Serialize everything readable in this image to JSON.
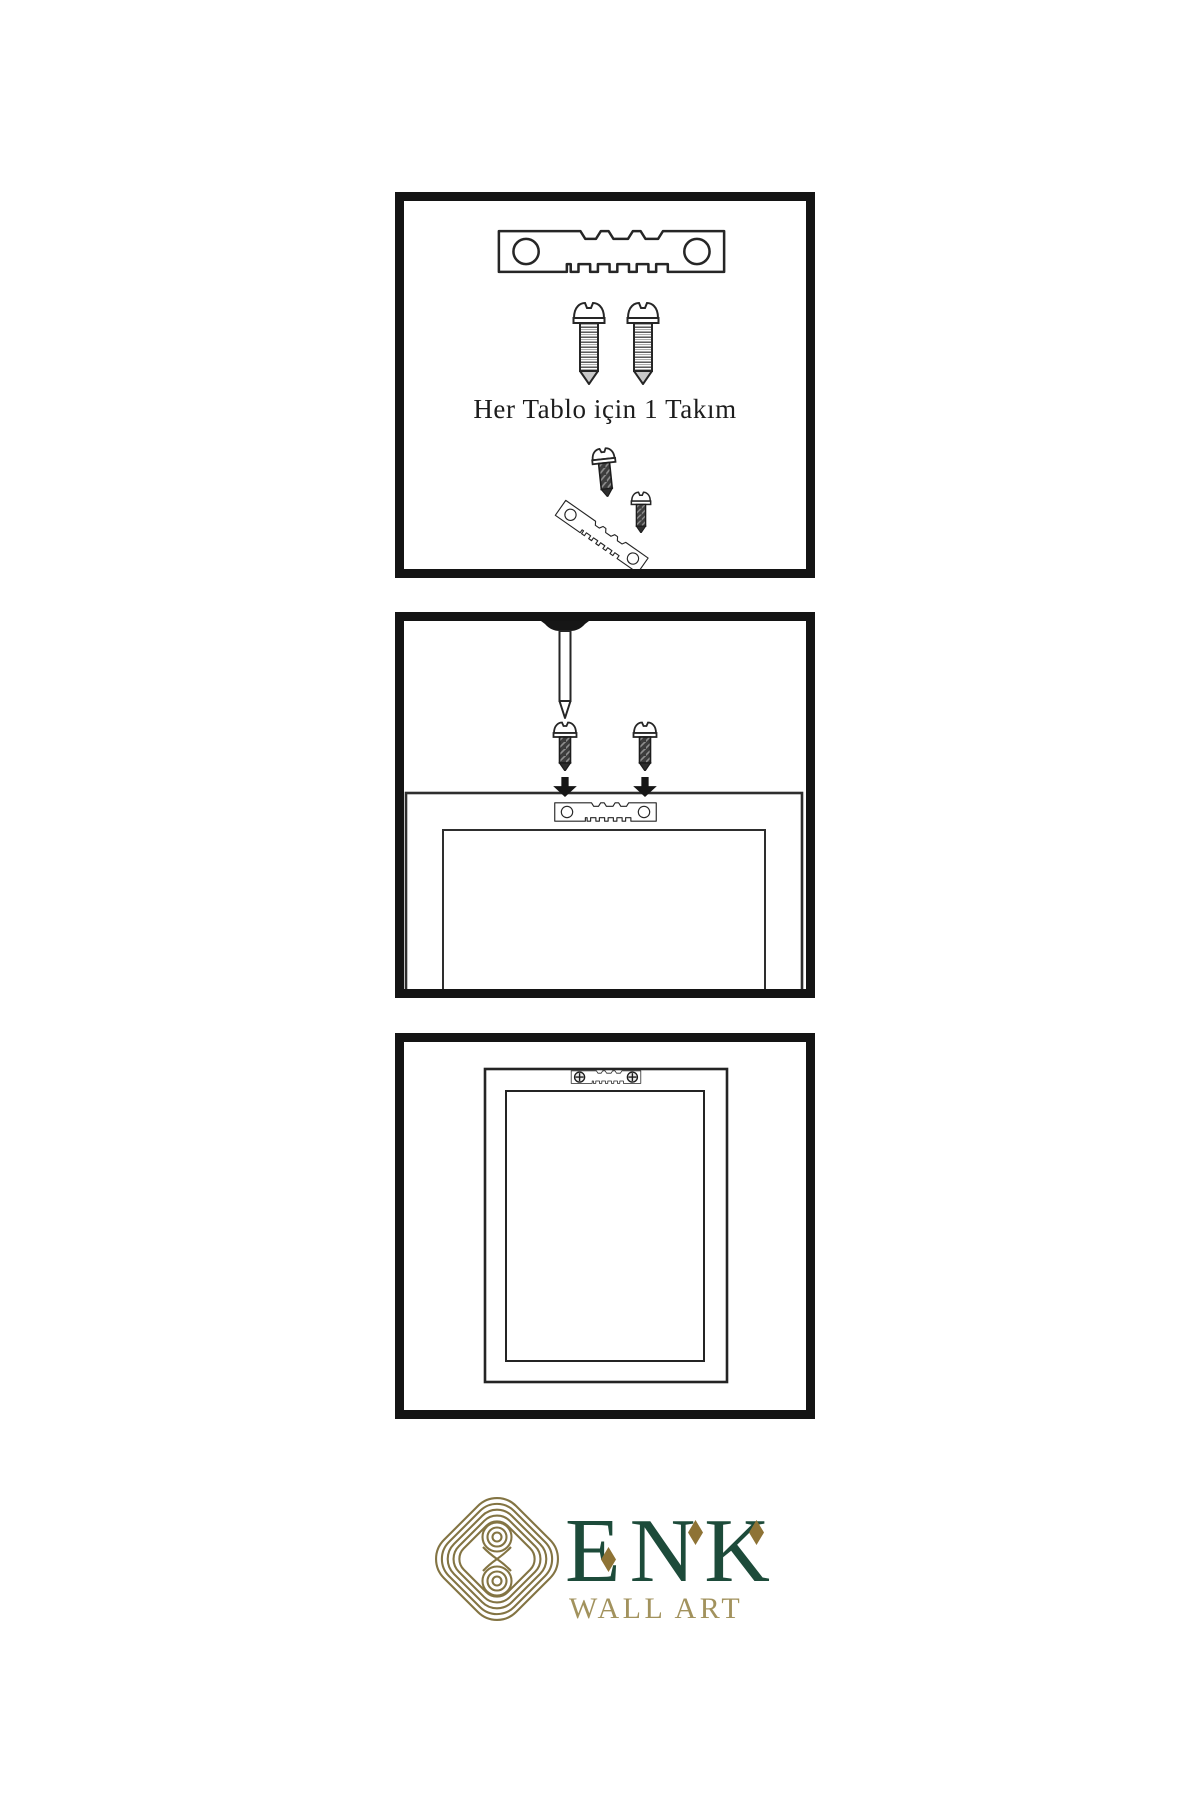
{
  "background": "#ffffff",
  "instruction": {
    "caption": "Her Tablo için 1 Takım"
  },
  "panels": {
    "step1": {
      "icons": [
        "sawtooth-hanger-icon",
        "screw-icon",
        "screw-icon",
        "screw-into-hanger-icon"
      ]
    },
    "step2": {
      "icons": [
        "nail-icon",
        "screw-icon",
        "screw-icon",
        "down-arrow-icon",
        "down-arrow-icon",
        "frame-back-with-hanger-icon"
      ]
    },
    "step3": {
      "icons": [
        "mounted-frame-icon",
        "sawtooth-hanger-with-screws-icon"
      ]
    }
  },
  "brand": {
    "name": "ENK",
    "tagline": "WALL ART",
    "color_green": "#1d4b3a",
    "color_knot_gold": "#837443",
    "color_tagline_gold": "#a2925d",
    "color_diamond_gold": "#8e7335",
    "line_color": "#262626"
  }
}
